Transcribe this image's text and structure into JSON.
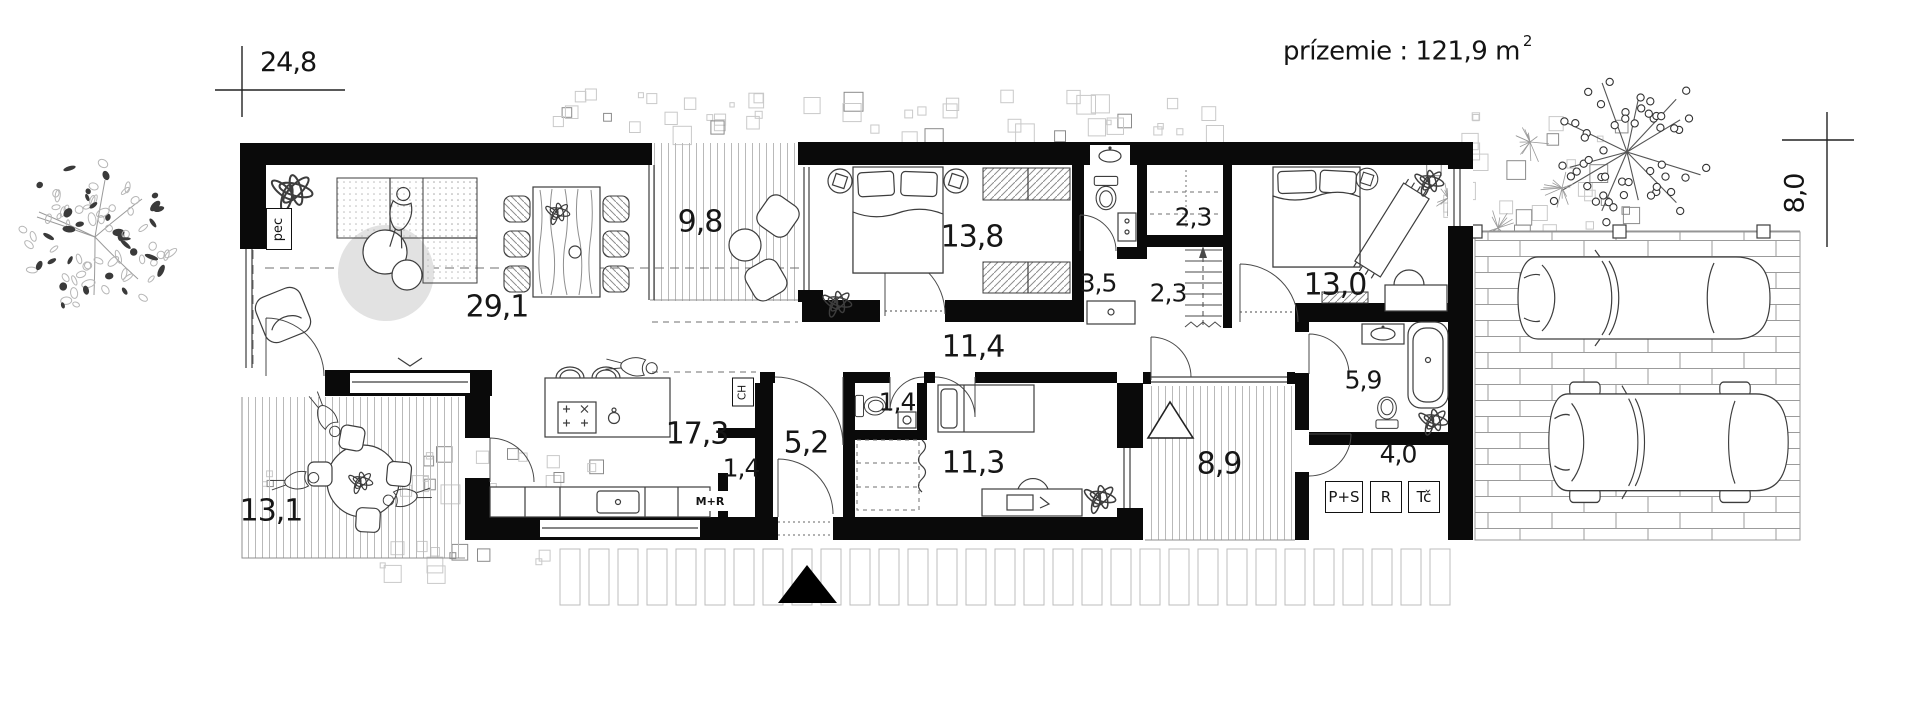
{
  "title": {
    "main": "prízemie : 121,9 m",
    "sup": "2"
  },
  "dimensions": {
    "width": "24,8",
    "height": "8,0"
  },
  "rooms": {
    "living": "29,1",
    "terrace_top": "9,8",
    "bedroom_left": "13,8",
    "closet_upper": "2,3",
    "bath_small": "3,5",
    "closet_lower": "2,3",
    "bedroom_right": "13,0",
    "hallway": "11,4",
    "bathroom": "5,9",
    "kitchen": "17,3",
    "pantry": "1,4",
    "entry_hall": "5,2",
    "wc": "1,4",
    "bedroom_small": "11,3",
    "entry_porch": "8,9",
    "tech_room": "4,0",
    "terrace_bottom": "13,1"
  },
  "equipment": {
    "pec": "pec",
    "ch": "CH",
    "mr": "M+R",
    "ps": "P+S",
    "r": "R",
    "tc": "Tč"
  }
}
